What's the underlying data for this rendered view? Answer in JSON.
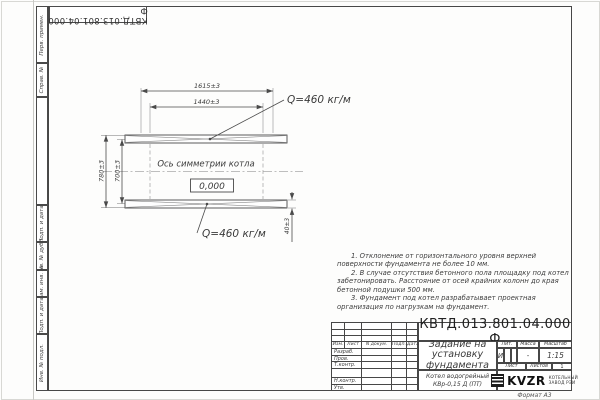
{
  "colors": {
    "ink": "#474747",
    "paper": "#fdfdfc"
  },
  "corner_stamp": {
    "designation": "КВТД.013.801.04.000 Ф"
  },
  "side_strip": {
    "cells": [
      "Перв. примен.",
      "Справ. №",
      "Подп. и дата",
      "Инв. № дубл.",
      "Взам. инв. №",
      "Подп. и дата",
      "Инв. № подл."
    ]
  },
  "drawing": {
    "dim_outer": "1615±3",
    "dim_inner": "1440±3",
    "dim_left_outer": "780±3",
    "dim_left_inner": "700±3",
    "dim_beam": "40±3",
    "load_top": "Q=460 кг/м",
    "load_bottom": "Q=460 кг/м",
    "axis_label": "Ось симметрии котла",
    "elevation": "0,000"
  },
  "notes": {
    "items": [
      "1. Отклонение от горизонтального уровня верхней поверхности фундамента не более 10 мм.",
      "2. В случае отсутствия бетонного пола площадку под котел забетонировать. Расстояние от осей крайних колонн до края бетонной подушки 500 мм.",
      "3. Фундамент под котел разрабатывает проектная организация по нагрузкам на фундамент."
    ]
  },
  "title_block": {
    "designation": "КВТД.013.801.04.000 Ф",
    "doc_title": "Задание на установку фундамента",
    "product_line1": "Котел водогрейный",
    "product_line2": "КВр-0,15 Д (ПТ)",
    "header_cols": [
      "Изм.",
      "Лист",
      "N докум.",
      "Подп.",
      "Дата"
    ],
    "sign_rows": [
      "Разраб.",
      "Пров.",
      "Т.контр.",
      "Н.контр.",
      "Утв."
    ],
    "lit_label": "Лит.",
    "lit_value": "И",
    "mass_label": "Масса",
    "mass_value": "-",
    "scale_label": "Масштаб",
    "scale_value": "1:15",
    "sheet_label": "Лист",
    "sheets_label": "Листов",
    "sheets_value": "1",
    "logo_text": "KVZR",
    "logo_caption_1": "КОТЕЛЬНЫЙ",
    "logo_caption_2": "ЗАВОД РЭИ",
    "format_label": "Формат А3"
  }
}
